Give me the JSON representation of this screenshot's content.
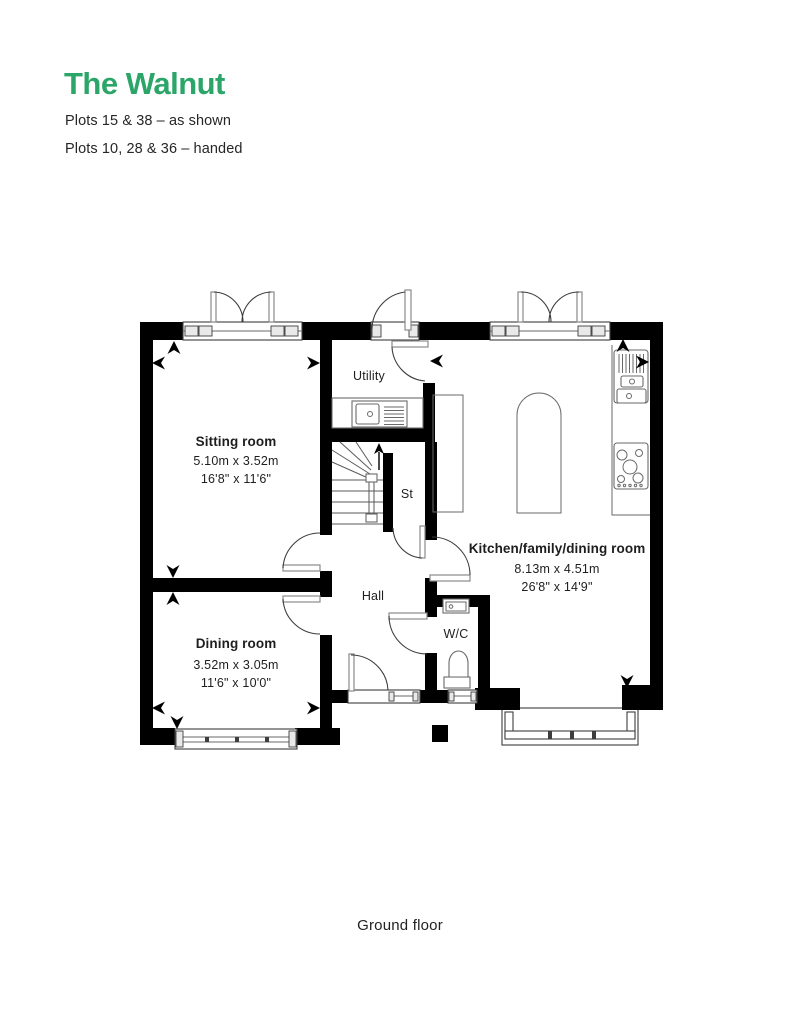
{
  "header": {
    "title": "The Walnut",
    "plots_as_shown": "Plots 15 & 38 – as shown",
    "plots_handed": "Plots 10, 28 & 36 – handed"
  },
  "floor": {
    "caption": "Ground floor"
  },
  "rooms": {
    "sitting": {
      "name": "Sitting room",
      "metric": "5.10m x 3.52m",
      "imperial": "16'8\" x 11'6\""
    },
    "dining": {
      "name": "Dining room",
      "metric": "3.52m x 3.05m",
      "imperial": "11'6\" x 10'0\""
    },
    "kitchen": {
      "name": "Kitchen/family/dining room",
      "metric": "8.13m x 4.51m",
      "imperial": "26'8\" x 14'9\""
    },
    "utility": {
      "name": "Utility"
    },
    "hall": {
      "name": "Hall"
    },
    "store": {
      "name": "St"
    },
    "wc": {
      "name": "W/C"
    }
  },
  "colors": {
    "accent_green": "#2ba568",
    "wall_black": "#000000",
    "text_dark": "#262626"
  }
}
